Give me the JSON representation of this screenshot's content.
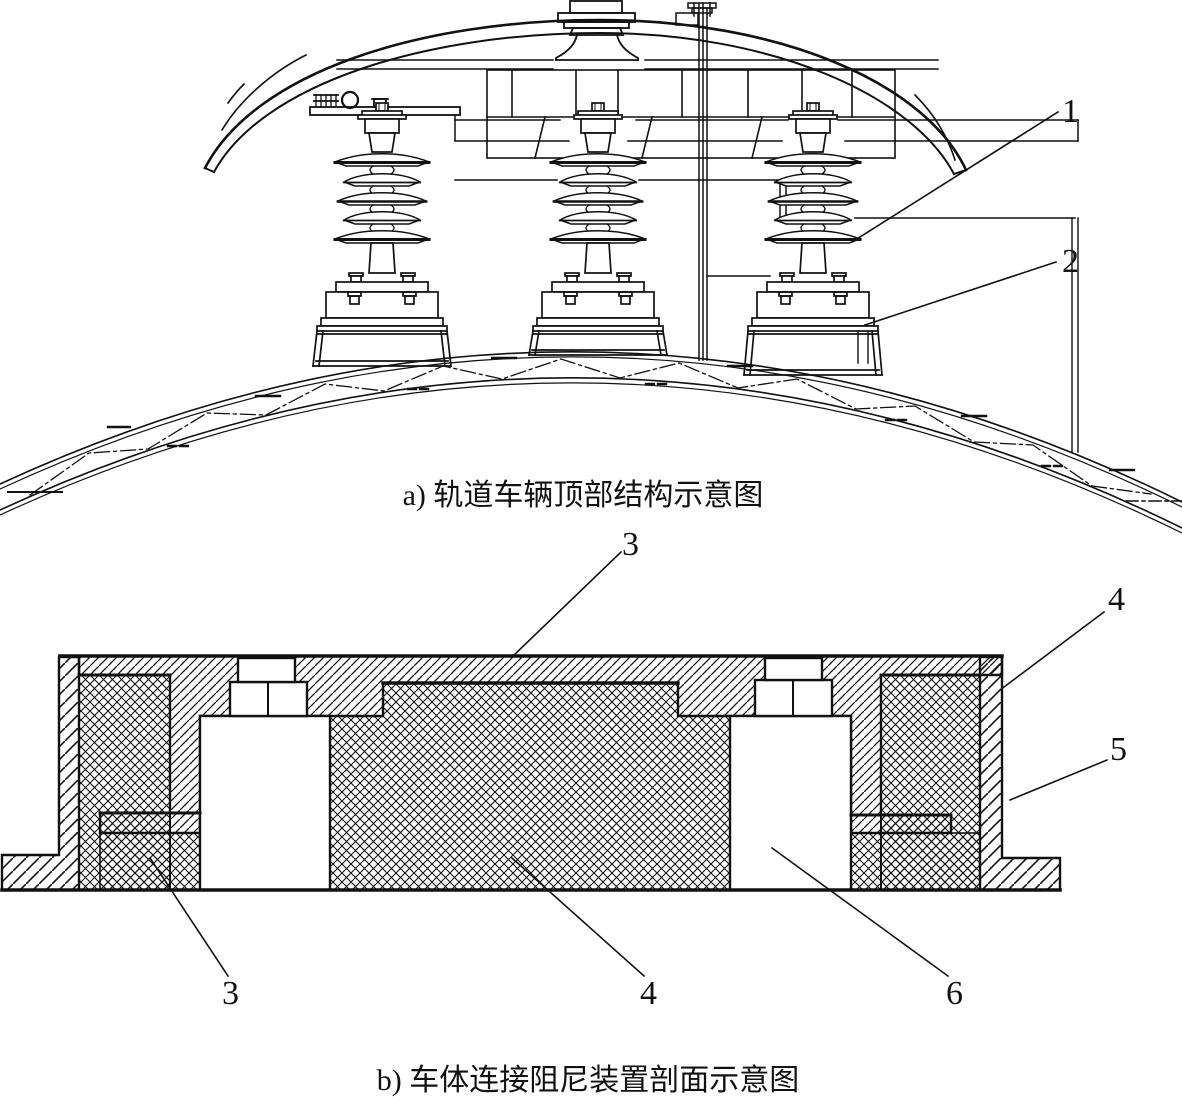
{
  "figure": {
    "panel_a": {
      "caption": "a) 轨道车辆顶部结构示意图"
    },
    "panel_b": {
      "caption": "b) 车体连接阻尼装置剖面示意图"
    },
    "callouts": {
      "c1": "1",
      "c2": "2",
      "c3_top": "3",
      "c4_top_right": "4",
      "c5": "5",
      "c3_bottom": "3",
      "c4_bottom": "4",
      "c6": "6"
    },
    "colors": {
      "line": "#111111",
      "background": "#ffffff"
    }
  }
}
